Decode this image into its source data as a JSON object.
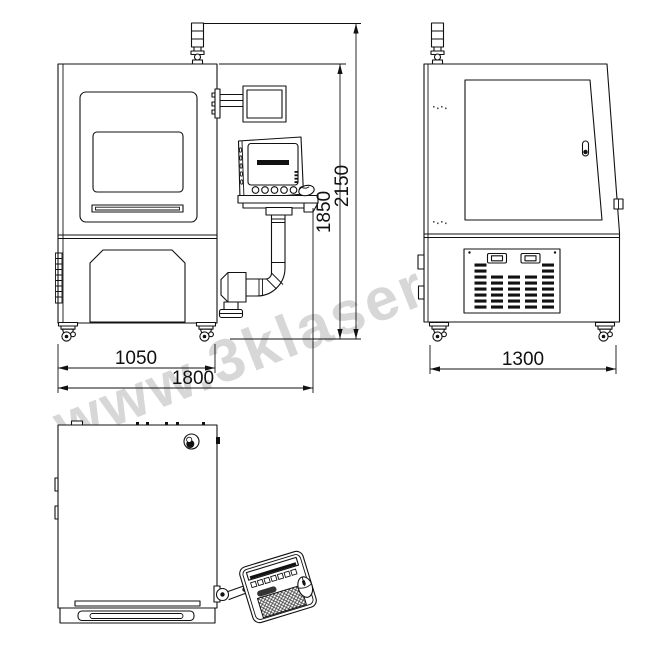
{
  "watermark": {
    "text": "www.3klaser.com"
  },
  "dimensions": {
    "front_inner_width": "1050",
    "front_overall_width": "1800",
    "cabinet_height": "1850",
    "overall_height": "2150",
    "side_width": "1300"
  },
  "colors": {
    "line": "#111111",
    "watermark": "#cdcdcd",
    "background": "#ffffff"
  }
}
